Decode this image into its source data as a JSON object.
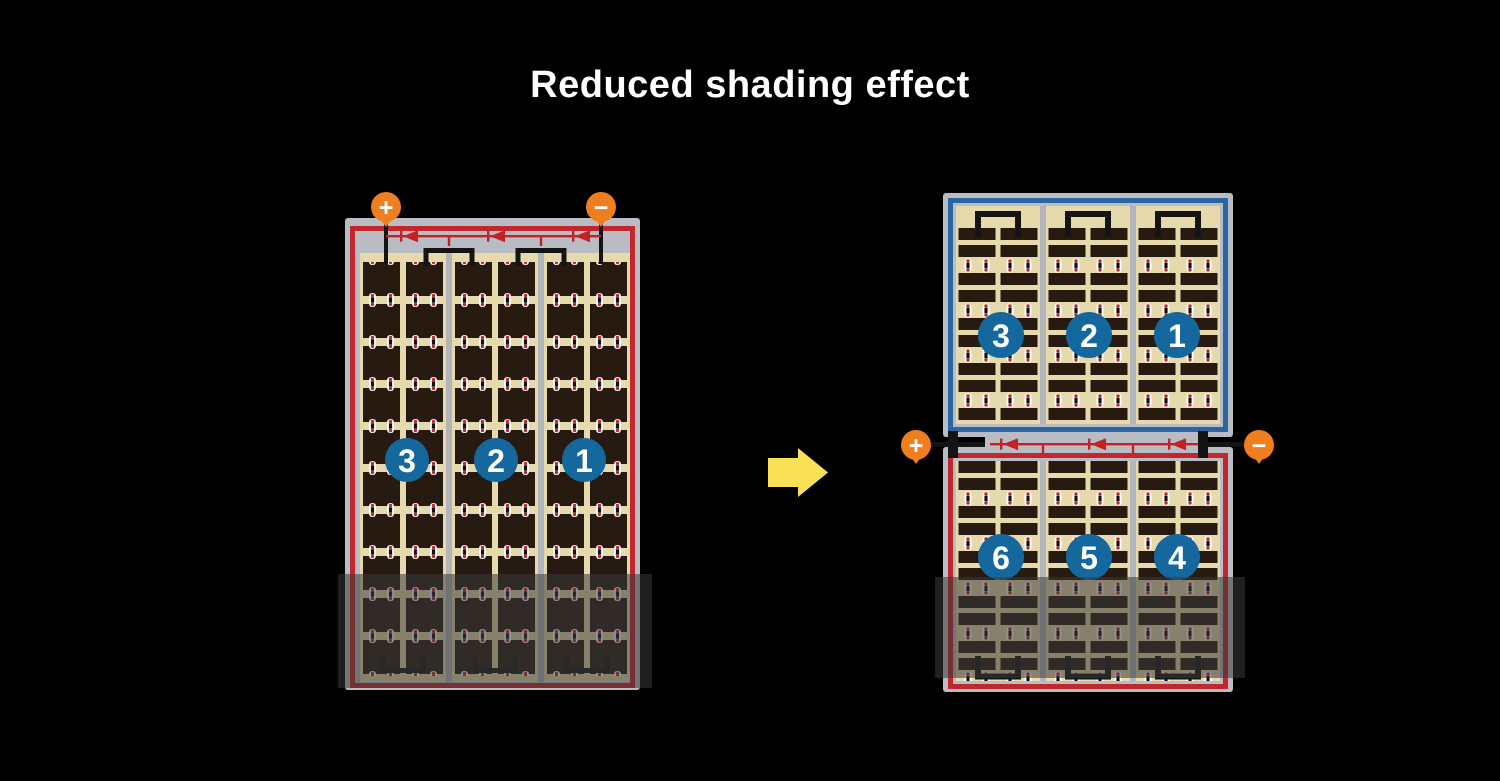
{
  "title": "Reduced shading effect",
  "left_panel": {
    "terminals": {
      "positive": "+",
      "negative": "−"
    },
    "cell_groups": [
      {
        "label": "3"
      },
      {
        "label": "2"
      },
      {
        "label": "1"
      }
    ],
    "bypass_diodes": 3
  },
  "right_panel": {
    "terminals": {
      "positive": "+",
      "negative": "−"
    },
    "top_half_groups": [
      {
        "label": "3"
      },
      {
        "label": "2"
      },
      {
        "label": "1"
      }
    ],
    "bottom_half_groups": [
      {
        "label": "6"
      },
      {
        "label": "5"
      },
      {
        "label": "4"
      }
    ],
    "bypass_diodes": 3
  },
  "icons": {
    "arrow": "arrow-right-icon",
    "positive_terminal": "plus-terminal-icon",
    "negative_terminal": "minus-terminal-icon",
    "bypass_diode": "diode-icon"
  },
  "colors": {
    "background": "#000000",
    "title_text": "#ffffff",
    "frame_gray": "#b9bcc2",
    "busbar_gray": "#b2b6bc",
    "surface_tan": "#e6d9ab",
    "cell_dark": "#271b11",
    "wire_black": "#141414",
    "border_red": "#c1272d",
    "border_blue": "#2b66a3",
    "diode_red": "#c42127",
    "group_circle_blue": "#15689e",
    "terminal_orange": "#ef7f1e",
    "arrow_yellow": "#f8e157",
    "shading_overlay": "rgba(56,56,56,0.55)"
  }
}
